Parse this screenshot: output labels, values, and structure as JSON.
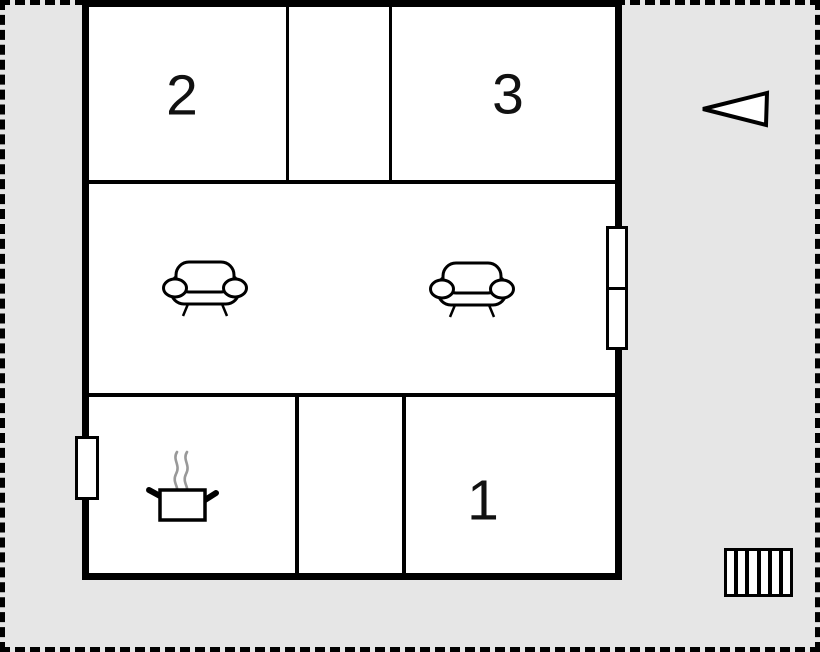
{
  "scene": {
    "type": "holiday-home floor plan",
    "background_color": "#e6e6e6",
    "wall_color": "#000000",
    "floor_color": "#ffffff",
    "steam_color": "#999999"
  },
  "rooms": [
    {
      "id": "room-2",
      "label": "2",
      "position": "top-left"
    },
    {
      "id": "room-3",
      "label": "3",
      "position": "top-right"
    },
    {
      "id": "room-1",
      "label": "1",
      "position": "bottom-right"
    },
    {
      "id": "living-room",
      "label": "",
      "position": "middle"
    },
    {
      "id": "kitchen",
      "label": "",
      "position": "bottom-left"
    }
  ],
  "furniture": [
    {
      "name": "sofa",
      "location": "living-room-left"
    },
    {
      "name": "sofa",
      "location": "living-room-right"
    },
    {
      "name": "cooking-pot-with-steam",
      "location": "kitchen"
    }
  ],
  "features": [
    {
      "name": "window",
      "location": "left-wall",
      "panes": 1
    },
    {
      "name": "double-window",
      "location": "right-wall",
      "panes": 2
    },
    {
      "name": "direction-arrow",
      "location": "outside-right",
      "points": "left"
    },
    {
      "name": "stairs",
      "location": "outside-bottom-right",
      "steps": 6
    }
  ]
}
